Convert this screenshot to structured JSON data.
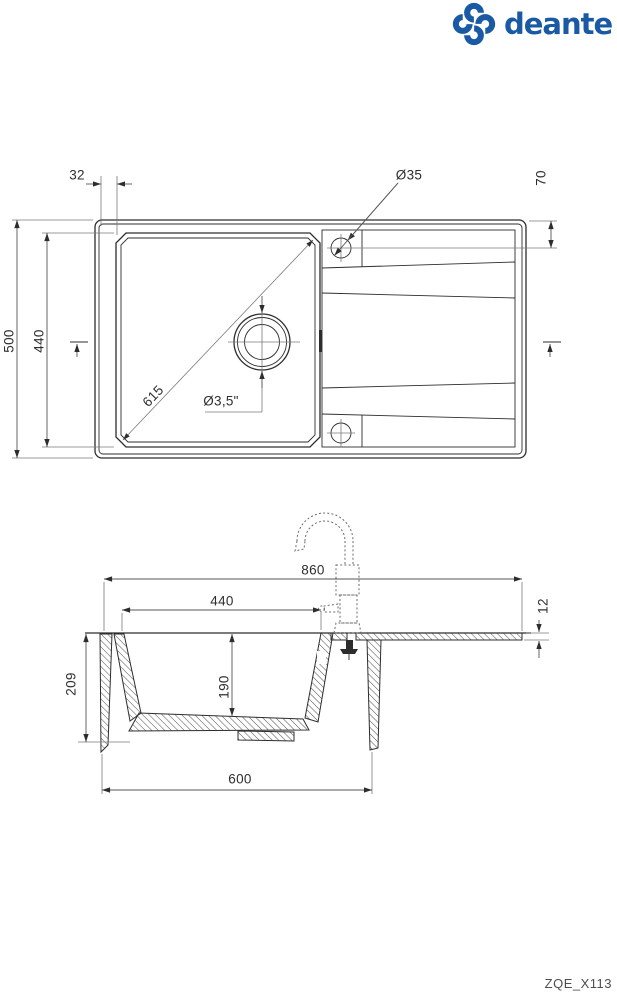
{
  "brand": {
    "wordmark": "deante",
    "color": "#1a5aa5"
  },
  "model_code": "ZQE_X113",
  "top_view": {
    "dims": {
      "rim_to_bowl_offset": "32",
      "tap_hole_diameter": "Ø35",
      "tap_hole_offset": "70",
      "overall_depth": "500",
      "bowl_depth": "440",
      "bowl_diagonal": "615",
      "drain_diameter": "Ø3,5\""
    }
  },
  "side_view": {
    "dims": {
      "overall_length": "860",
      "bowl_length": "440",
      "edge_thickness": "12",
      "overall_height": "209",
      "bowl_height": "190",
      "base_cabinet": "600"
    }
  }
}
